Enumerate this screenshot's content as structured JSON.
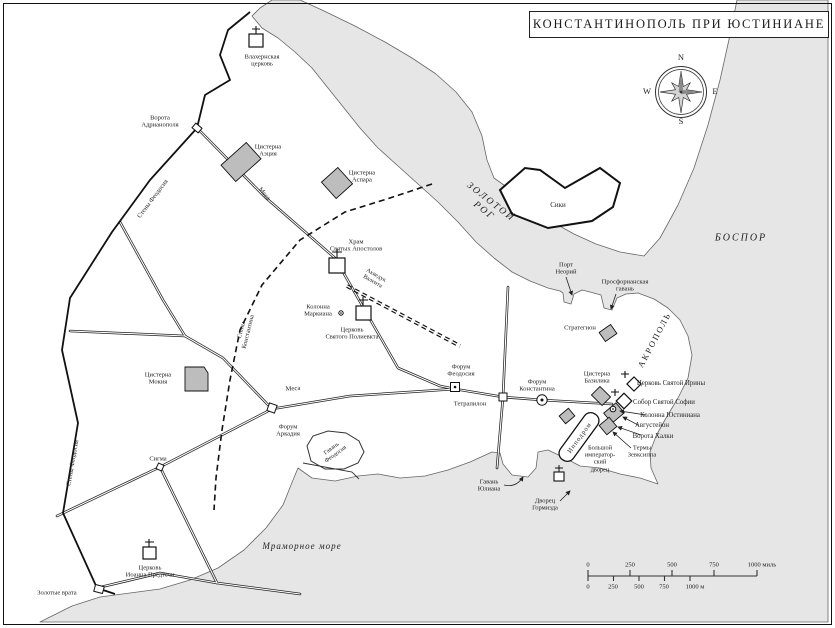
{
  "title": "КОНСТАНТИНОПОЛЬ ПРИ ЮСТИНИАНЕ",
  "colors": {
    "sea": "#e6e6e6",
    "land": "#ffffff",
    "building": "#bdbdbd",
    "line": "#1a1a1a"
  },
  "water": {
    "golden_horn": "ЗОЛОТОЙ\nРОГ",
    "bosporus": "БОСПОР",
    "marmara": "Мраморное море"
  },
  "districts": {
    "sykai": "Сики",
    "acropolis": "АКРОПОЛЬ",
    "hippodrome": "Ипподром"
  },
  "walls_roads": {
    "theodosian_wall_upper": "Стены Феодосия",
    "theodosian_wall_lower": "Стены Феодосия",
    "constantine_wall": "Стены\nКонстантина",
    "mesa_north": "Меса",
    "mesa_main": "Меса",
    "aqueduct": "Акведук\nВалента"
  },
  "gates": {
    "adrianople": "Ворота\nАдрианополя",
    "golden": "Золотые врата",
    "chalke": "Ворота Халки"
  },
  "churches": {
    "blachernae": "Влахернская\nцерковь",
    "holy_apostles": "Храм\nСвятых Апостолов",
    "polyeuktos": "Церковь\nСвятого Полиевкта",
    "john_baptist": "Церковь\nИоанна Предтечи",
    "st_irene": "Церковь Святой Ирины",
    "st_sophia": "Собор Святой Софии"
  },
  "cisterns": {
    "aetius": "Цистерна\nАэция",
    "aspar": "Цистерна\nАспара",
    "mocius": "Цистерна\nМокия",
    "basilica": "Цистерна\nБазилика"
  },
  "forums": {
    "theodosius": "Форум\nФеодосия",
    "constantine": "Форум\nКонстантина",
    "arcadius": "Форум\nАркадия",
    "sigma": "Сигма"
  },
  "monuments": {
    "marcian_column": "Колонна\nМаркиана",
    "justinian_column": "Колонна Юстиниана",
    "augustaion": "Августейон",
    "zeuxippus": "Термы\nЗевксиппа",
    "great_palace": "Большой\nимператор-\nский\nдворец",
    "hormisdas": "Дворец\nГормизда",
    "strategion": "Стратегион",
    "tetrapylon": "Тетрапилон"
  },
  "harbors": {
    "neorion": "Порт\nНеорий",
    "prosphorion": "Просфорианская\nгавань",
    "theodosius": "Гавань\nФеодосия",
    "julian": "Гавань\nЮлиана"
  },
  "compass": {
    "n": "N",
    "e": "E",
    "s": "S",
    "w": "W"
  },
  "scale": {
    "miles": [
      "0",
      "250",
      "500",
      "750"
    ],
    "miles_end": "1000 миль",
    "meters": [
      "0",
      "250",
      "500",
      "750"
    ],
    "meters_end": "1000 м"
  }
}
